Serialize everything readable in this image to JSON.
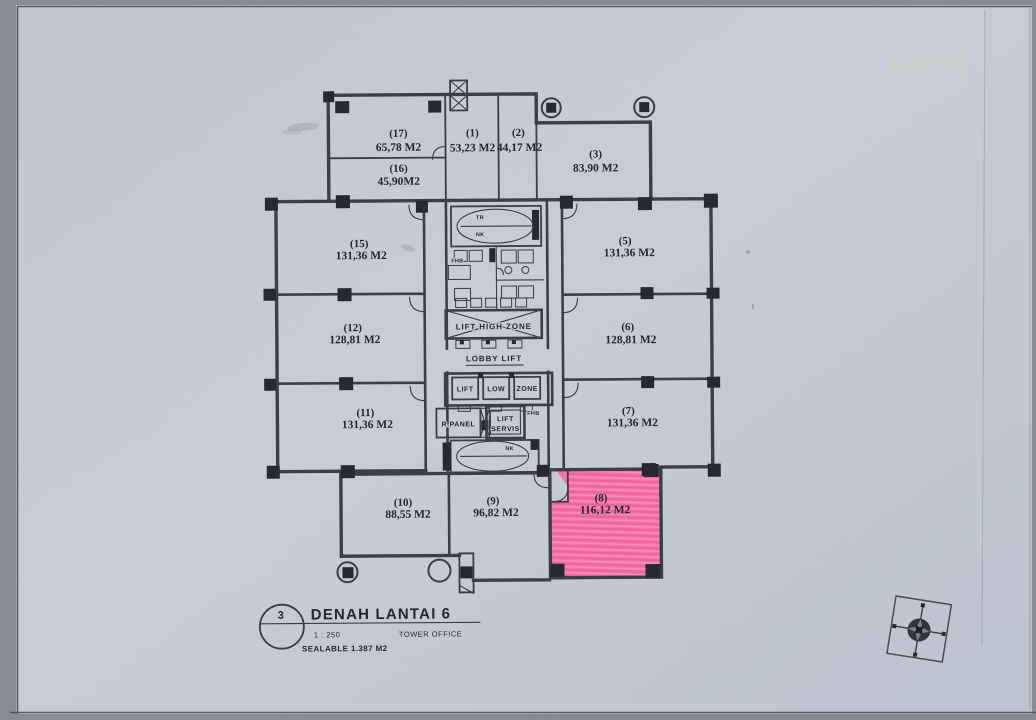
{
  "document": {
    "sheet_number": "3",
    "title": "DENAH LANTAI",
    "floor_number": "6",
    "scale": "1 : 250",
    "building_label": "TOWER OFFICE",
    "saleable_label": "SEALABLE 1.387 M2"
  },
  "units": {
    "u1": {
      "no": "(1)",
      "area": "53,23 M2"
    },
    "u2": {
      "no": "(2)",
      "area": "44,17 M2"
    },
    "u3": {
      "no": "(3)",
      "area": "83,90 M2"
    },
    "u5": {
      "no": "(5)",
      "area": "131,36 M2"
    },
    "u6": {
      "no": "(6)",
      "area": "128,81 M2"
    },
    "u7": {
      "no": "(7)",
      "area": "131,36 M2"
    },
    "u8": {
      "no": "(8)",
      "area": "116,12 M2",
      "highlighted": true
    },
    "u9": {
      "no": "(9)",
      "area": "96,82 M2"
    },
    "u10": {
      "no": "(10)",
      "area": "88,55 M2"
    },
    "u11": {
      "no": "(11)",
      "area": "131,36 M2"
    },
    "u12": {
      "no": "(12)",
      "area": "128,81 M2"
    },
    "u15": {
      "no": "(15)",
      "area": "131,36 M2"
    },
    "u16": {
      "no": "(16)",
      "area": "45,90M2"
    },
    "u17": {
      "no": "(17)",
      "area": "65,78 M2"
    }
  },
  "core": {
    "lift_high_zone": "LIFT HIGH ZONE",
    "lobby_lift": "LOBBY LIFT",
    "lift_low_zone": [
      "LIFT",
      "LOW",
      "ZONE"
    ],
    "lift_servis": [
      "LIFT",
      "SERVIS"
    ],
    "r_panel": "R.PANEL",
    "fhb_left": "FHB",
    "fhb_right": "FHB",
    "stair_top": [
      "TR",
      "NK"
    ],
    "stair_bottom": "NK"
  },
  "colors": {
    "paper": "#c7ccd5",
    "ink": "#3b3e45",
    "ink_fill": "#26292f",
    "highlight": "#f76ba4"
  }
}
